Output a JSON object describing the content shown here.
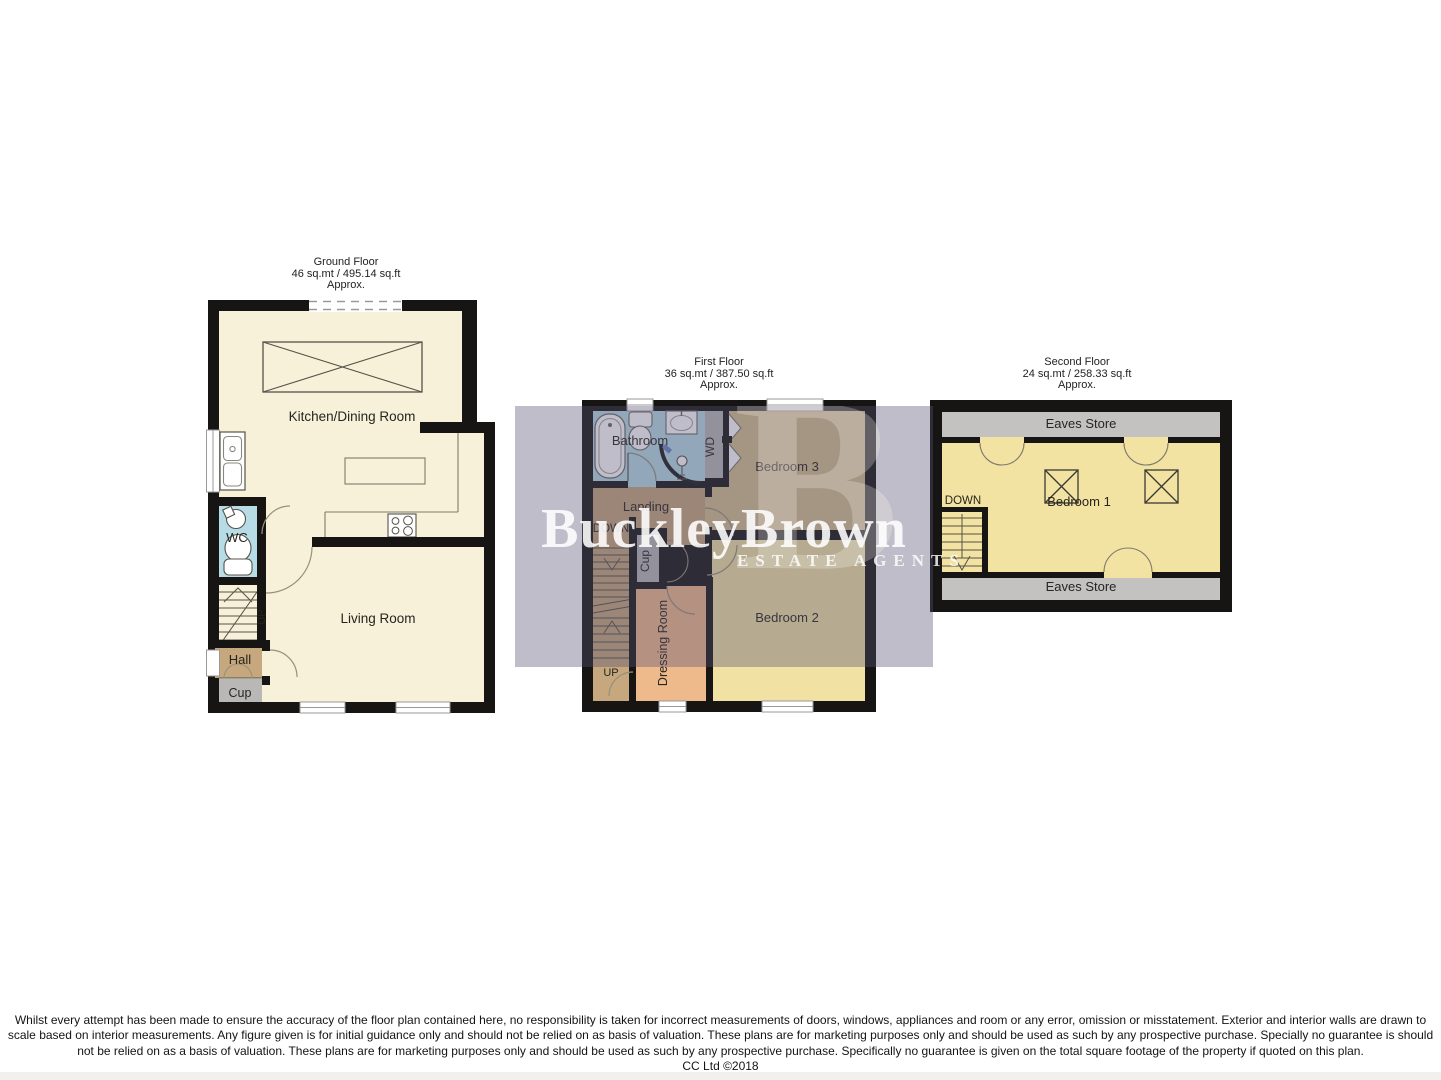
{
  "floors": {
    "ground": {
      "title": "Ground Floor",
      "area": "46 sq.mt / 495.14 sq.ft",
      "approx": "Approx.",
      "rooms": {
        "kitchen": "Kitchen/Dining Room",
        "wc": "WC",
        "living": "Living Room",
        "hall": "Hall",
        "cup": "Cup",
        "up": "UP"
      }
    },
    "first": {
      "title": "First Floor",
      "area": "36 sq.mt / 387.50 sq.ft",
      "approx": "Approx.",
      "rooms": {
        "bathroom": "Bathroom",
        "wd": "WD",
        "bedroom3": "Bedroom 3",
        "landing": "Landing",
        "down": "DOWN",
        "cup": "Cup",
        "dressing": "Dressing Room",
        "bedroom2": "Bedroom 2",
        "up": "UP"
      }
    },
    "second": {
      "title": "Second Floor",
      "area": "24 sq.mt / 258.33 sq.ft",
      "approx": "Approx.",
      "rooms": {
        "eaves_top": "Eaves Store",
        "bedroom1": "Bedroom 1",
        "down": "DOWN",
        "eaves_bottom": "Eaves Store"
      }
    }
  },
  "watermark": {
    "brand": "BuckleyBrown",
    "tagline": "ESTATE AGENTS",
    "ghost_letter": "B",
    "text_color": "#ffffff",
    "band_color": "rgba(86,82,112,0.38)"
  },
  "disclaimer": {
    "lines": [
      "Whilst every attempt has been made to ensure the accuracy of the floor plan contained here, no responsibility is taken for incorrect measurements of doors, windows, appliances and room or any error, omission or misstatement. Exterior and interior walls are drawn to",
      "scale based on interior measurements. Any figure given is for initial guidance only and should not be relied on as basis of valuation. These plans are for marketing purposes only and should be used as such by any prospective purchase. Specially no guarantee is should",
      "not be relied on as a basis of valuation. These plans are for marketing purposes only and should be used as such by any prospective purchase. Specifically no guarantee is given on the total square footage of the property if quoted on this plan.",
      "CC Ltd ©2018"
    ]
  },
  "colors": {
    "wall": "#161513",
    "cream": "#f6f1d8",
    "blue": "#b7dce6",
    "brown": "#c7a77d",
    "closet_gray": "#b9b8b6",
    "eaves_gray": "#c3c2c0",
    "peach": "#eeb98b",
    "tan": "#d5bf8f",
    "pale_yellow": "#f1e2a4",
    "yellow": "#f3e3a2",
    "window_white": "#ffffff"
  }
}
